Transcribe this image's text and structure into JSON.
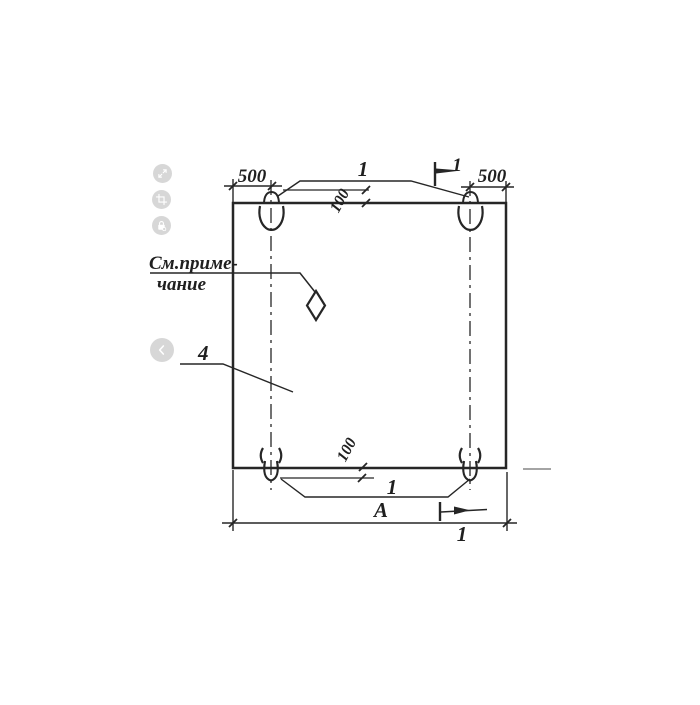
{
  "viewer": {
    "buttons": [
      {
        "name": "expand-button",
        "icon": "expand-icon"
      },
      {
        "name": "crop-button",
        "icon": "crop-icon"
      },
      {
        "name": "lock-button",
        "icon": "lock-icon"
      },
      {
        "name": "prev-image-button",
        "icon": "chevron-left-icon"
      }
    ],
    "colors": {
      "button_bg": "#d7d7d7",
      "icon": "#ffffff"
    }
  },
  "drawing": {
    "kind": "hand-drawn construction panel drawing with lifting loops",
    "colors": {
      "ink": "#262626",
      "paper": "#ffffff",
      "faint_line": "#858585"
    },
    "labels": {
      "dim_top_left": "500",
      "dim_top_right": "500",
      "callout_top_loops": "1",
      "dim_top_offset": "100",
      "section_mark_top": "1",
      "note_line1": "См.приме-",
      "note_line2": "чание",
      "callout_panel": "4",
      "dim_bottom_offset": "100",
      "callout_bottom_loops": "1",
      "dim_width": "А",
      "section_mark_bottom": "1"
    }
  }
}
